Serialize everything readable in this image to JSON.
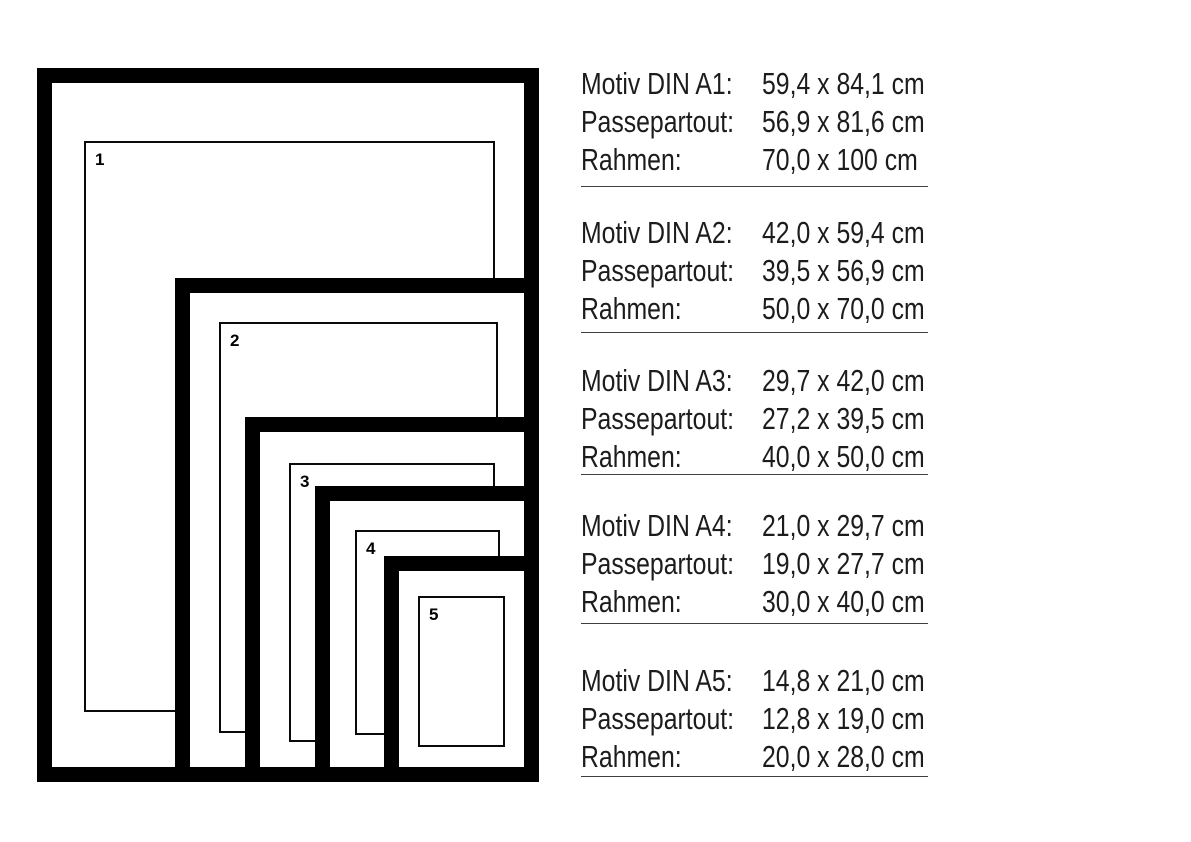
{
  "diagram": {
    "frames": [
      {
        "label": "1"
      },
      {
        "label": "2"
      },
      {
        "label": "3"
      },
      {
        "label": "4"
      },
      {
        "label": "5"
      }
    ]
  },
  "specs": [
    {
      "rows": [
        {
          "label": "Motiv DIN A1:",
          "value": "59,4 x 84,1 cm"
        },
        {
          "label": "Passepartout:",
          "value": "56,9 x 81,6 cm"
        },
        {
          "label": "Rahmen:",
          "value": "70,0 x 100 cm"
        }
      ]
    },
    {
      "rows": [
        {
          "label": "Motiv DIN A2:",
          "value": "42,0 x 59,4 cm"
        },
        {
          "label": "Passepartout:",
          "value": "39,5 x 56,9 cm"
        },
        {
          "label": "Rahmen:",
          "value": "50,0 x 70,0 cm"
        }
      ]
    },
    {
      "rows": [
        {
          "label": "Motiv DIN A3:",
          "value": "29,7 x 42,0 cm"
        },
        {
          "label": "Passepartout:",
          "value": "27,2 x 39,5 cm"
        },
        {
          "label": "Rahmen:",
          "value": "40,0 x 50,0 cm"
        }
      ]
    },
    {
      "rows": [
        {
          "label": "Motiv DIN A4:",
          "value": "21,0 x 29,7 cm"
        },
        {
          "label": "Passepartout:",
          "value": "19,0 x 27,7 cm"
        },
        {
          "label": "Rahmen:",
          "value": "30,0 x 40,0 cm"
        }
      ]
    },
    {
      "rows": [
        {
          "label": "Motiv DIN A5:",
          "value": "14,8 x 21,0 cm"
        },
        {
          "label": "Passepartout:",
          "value": "12,8 x 19,0 cm"
        },
        {
          "label": "Rahmen:",
          "value": "20,0 x 28,0 cm"
        }
      ]
    }
  ],
  "colors": {
    "frame": "#000000",
    "text": "#1c1c1c",
    "separator": "#3f3f3f",
    "background": "#ffffff"
  }
}
